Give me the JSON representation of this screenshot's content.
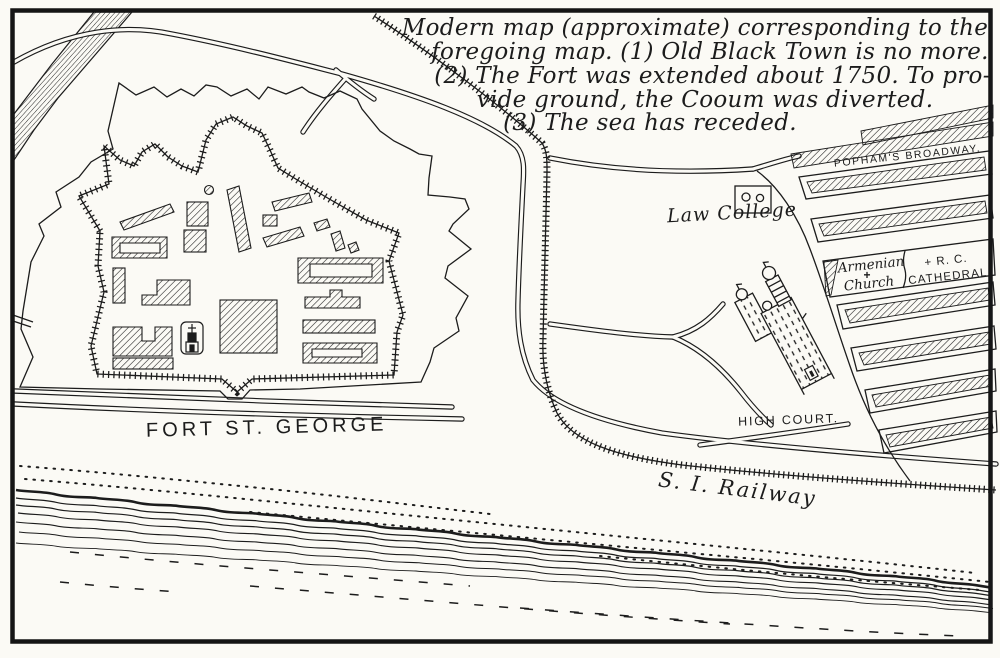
{
  "annotation": {
    "lines": [
      "Modern map (approximate) corresponding to the",
      "foregoing map.  (1) Old Black Town is no more.",
      "(2) The Fort was extended about 1750.  To pro-",
      "vide ground, the Cooum was diverted.",
      "(3) The sea has receded."
    ]
  },
  "labels": {
    "pophams_broadway": "POPHAM'S BROADWAY.",
    "law_college": "Law College",
    "armenian_line1": "Armenian",
    "armenian_line2": "Church",
    "armenian_cross": "+",
    "rc_line1": "+ R. C.",
    "rc_line2": "CATHEDRAL",
    "high_court": "HIGH COURT.",
    "fort": "FORT ST. GEORGE",
    "railway": "S. I. Railway"
  },
  "features": {
    "fort_plan": "star-fort-with-hatched-buildings",
    "church_in_fort": "st-marys-church-plot",
    "river": "cooum-river-flow-lines",
    "railway_line": "cross-ticked-railway",
    "city_blocks": "hatched-street-blocks",
    "sea": "wavy-shoreline-with-stipple"
  },
  "colors": {
    "paper": "#fbfaf5",
    "ink": "#1c1c1c"
  }
}
